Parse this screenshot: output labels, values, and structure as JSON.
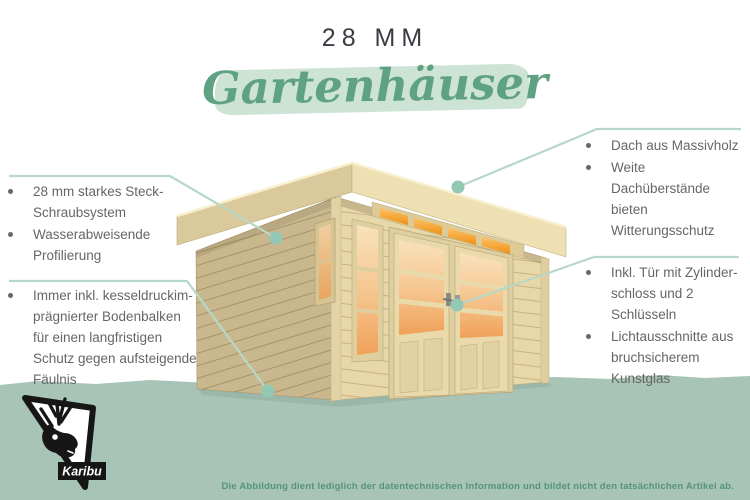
{
  "header": {
    "size_label": "28 MM",
    "category_title": "Gartenhäuser"
  },
  "callouts": {
    "left_top": {
      "items": [
        "28 mm starkes Steck-\nSchraubsystem",
        "Wasserabweisende\nProfilierung"
      ]
    },
    "left_bottom": {
      "items": [
        "Immer inkl. kesseldruckim-\nprägnierter Bodenbalken\nfür einen langfristigen\nSchutz gegen aufsteigende\nFäulnis"
      ]
    },
    "right_top": {
      "items": [
        "Dach aus Massivholz",
        "Weite Dachüberstände\nbieten Witterungsschutz"
      ]
    },
    "right_bottom": {
      "items": [
        "Inkl. Tür mit Zylinder-\nschloss und 2 Schlüsseln",
        "Lichtausschnitte aus\nbruchsicherem Kunstglas"
      ]
    }
  },
  "brand": {
    "logo_text": "Karibu",
    "logo_icon": "caribou-head-icon"
  },
  "footer": {
    "disclaimer": "Die Abbildung dient lediglich der datentechnischen Information und bildet nicht den tatsächlichen Artikel ab."
  },
  "illustration": {
    "subject": "wooden flat-roof garden house with double doors, clerestory transom window, front window and side window standing on green ground"
  },
  "colors": {
    "accent_green": "#5fa183",
    "brush_green": "#cde3d6",
    "ground_green": "#a7c4b6",
    "leader_line": "#b7d7c7",
    "leader_dot": "#93c8b4",
    "footer_text": "#55927f",
    "title_dark": "#3b3b44",
    "body_text": "#666666",
    "wood_light": "#e7d7a9",
    "wood_dark": "#c9b88e",
    "glow_orange": "#f0a159"
  }
}
